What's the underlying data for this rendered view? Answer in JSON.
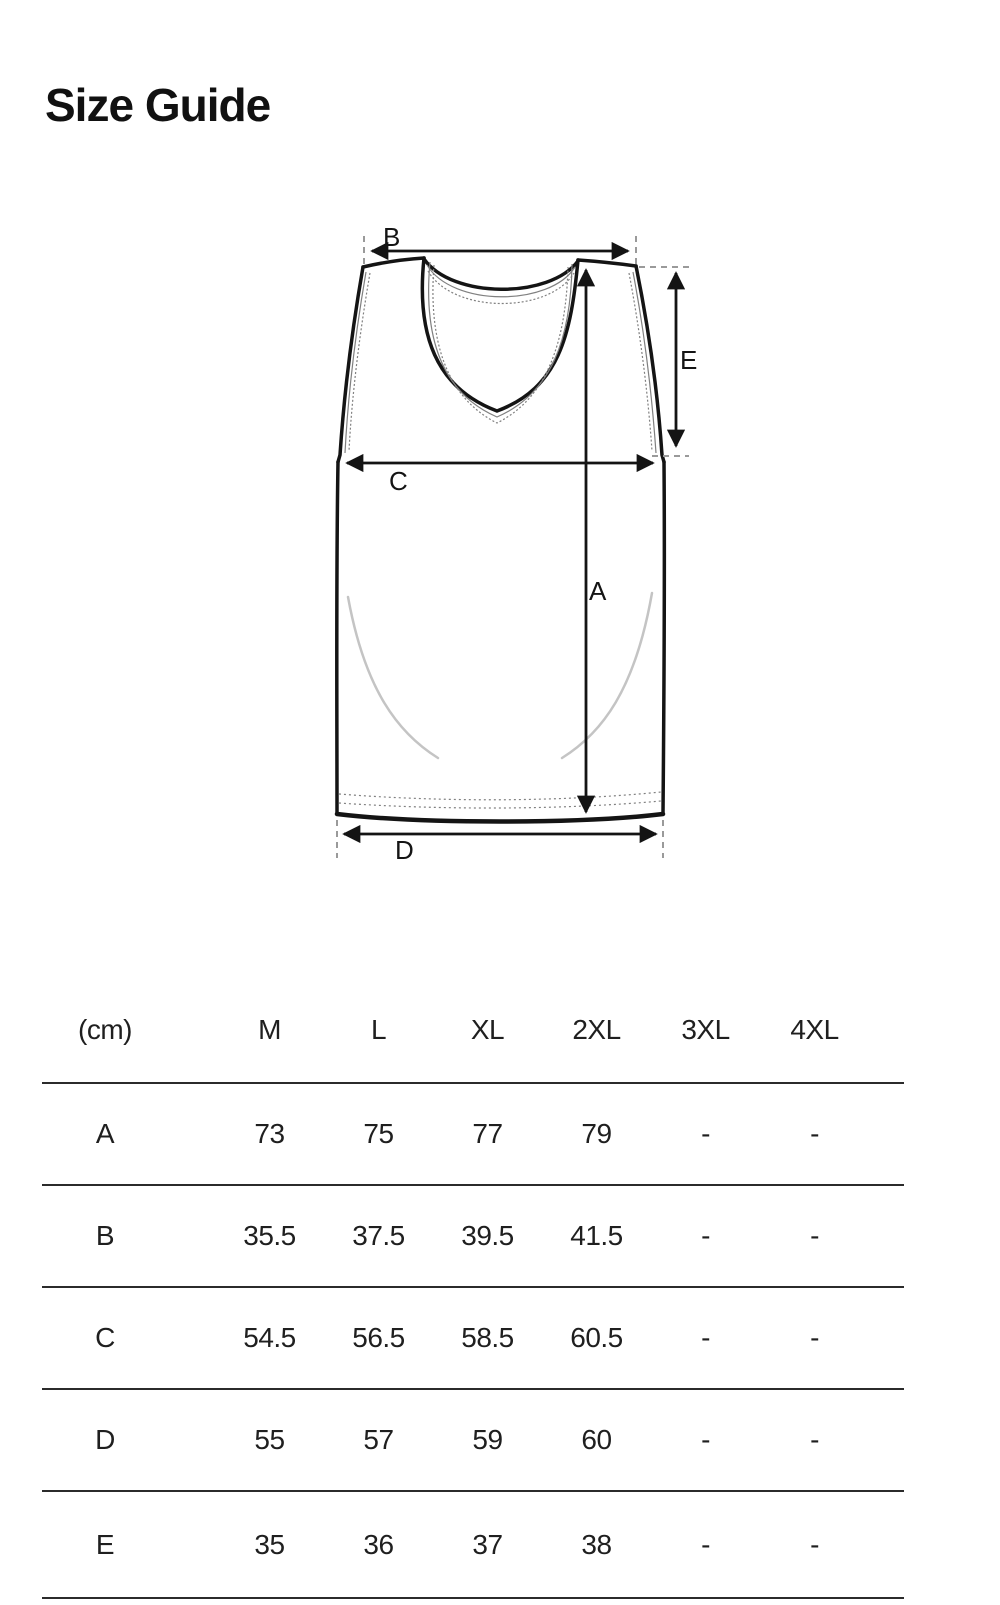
{
  "page": {
    "title": "Size Guide"
  },
  "diagram": {
    "labels": {
      "A": "A",
      "B": "B",
      "C": "C",
      "D": "D",
      "E": "E"
    }
  },
  "table": {
    "unit_header": "(cm)",
    "columns": [
      "M",
      "L",
      "XL",
      "2XL",
      "3XL",
      "4XL"
    ],
    "rows": [
      {
        "label": "A",
        "values": [
          "73",
          "75",
          "77",
          "79",
          "-",
          "-"
        ]
      },
      {
        "label": "B",
        "values": [
          "35.5",
          "37.5",
          "39.5",
          "41.5",
          "-",
          "-"
        ]
      },
      {
        "label": "C",
        "values": [
          "54.5",
          "56.5",
          "58.5",
          "60.5",
          "-",
          "-"
        ]
      },
      {
        "label": "D",
        "values": [
          "55",
          "57",
          "59",
          "60",
          "-",
          "-"
        ]
      },
      {
        "label": "E",
        "values": [
          "35",
          "36",
          "37",
          "38",
          "-",
          "-"
        ]
      }
    ]
  }
}
